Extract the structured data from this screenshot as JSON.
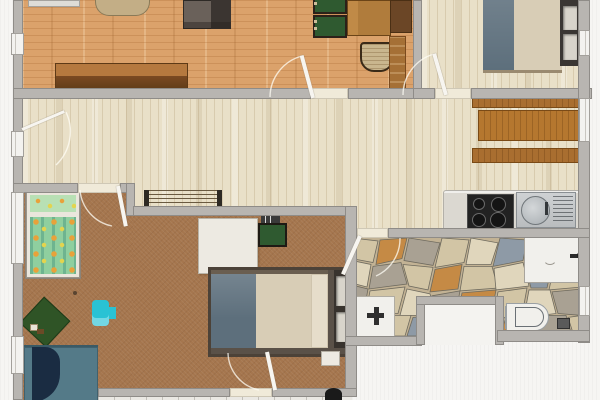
{
  "scene": {
    "type": "apartment-floor-plan-3d-top-view",
    "rooms": [
      "living-room",
      "bedroom",
      "hallway",
      "kitchen",
      "family-bedroom",
      "bathroom",
      "terrace"
    ],
    "furniture": [
      "sofa",
      "side-table",
      "dining-table",
      "dining-chair",
      "sideboard",
      "tall-cabinet",
      "double-bed",
      "wall-shelf",
      "kitchen-cabinet",
      "cooktop",
      "kitchen-sink",
      "radiator",
      "kids-bed",
      "desk",
      "desk-chair",
      "laptop",
      "bed",
      "nightstand",
      "play-mat",
      "toy",
      "day-bed",
      "shower",
      "washbasin",
      "toilet",
      "toilet-brush",
      "plant-pot"
    ]
  },
  "colors": {
    "outside": "#f6f5f3",
    "wall": "#b8b5b1",
    "wall_edge": "#8f8c88",
    "wall_light": "#dedcd7",
    "floor_living": "#dba26b",
    "floor_hall": "#e9e0c8",
    "floor_master": "#a5764e",
    "floor_stone_base": "#c2b294",
    "floor_tile": "#eae8e3",
    "threshold": "#f0ead9",
    "window_white": "#f3f2ef",
    "door_leaf": "#f7f5f0",
    "stone1": "#d2c5a5",
    "stone2": "#a9a193",
    "stone3": "#8e9aa6",
    "stone4": "#c58a45",
    "stone5": "#e0d6bc",
    "stone_line": "#6e6a5e",
    "sofa_body": "#6a615a",
    "sofa_dark": "#3b3531",
    "chair_green": "#2f5a30",
    "chair_frame": "#2b2119",
    "chair_wicker": "#c9b68e",
    "dining_table": "#b07c3c",
    "side_table": "#c3ae86",
    "sideboard_top": "#b5793f",
    "sideboard_front": "#7a4a22",
    "cabinet_dark": "#6b4626",
    "cabinet_mid": "#a57036",
    "kitchen_cabinet": "#a96e30",
    "counter": "#dbd8d1",
    "cooktop": "#222222",
    "steel": "#b9bcbe",
    "bed_blanket": "#5d6f7c",
    "bed_mattress": "#d8cdb6",
    "bed_frame": "#4c4238",
    "headboard": "#38332e",
    "shelf": "#3a3633",
    "niche": "#d8d4cb",
    "kids_frame": "#eae6dc",
    "kids_bedding": "#8fcf9f",
    "kids_dot_orange": "#e8a23a",
    "kids_dot_yellow": "#e3d44e",
    "desk": "#edeae2",
    "teal_sofa": "#547a88",
    "teal_blanket": "#1a2c42",
    "toy_cyan": "#29c2d4",
    "playmat": "#2f5426",
    "fixture": "#f1f0ec",
    "radiator": "#6a5a40",
    "black": "#1a1a1a"
  }
}
